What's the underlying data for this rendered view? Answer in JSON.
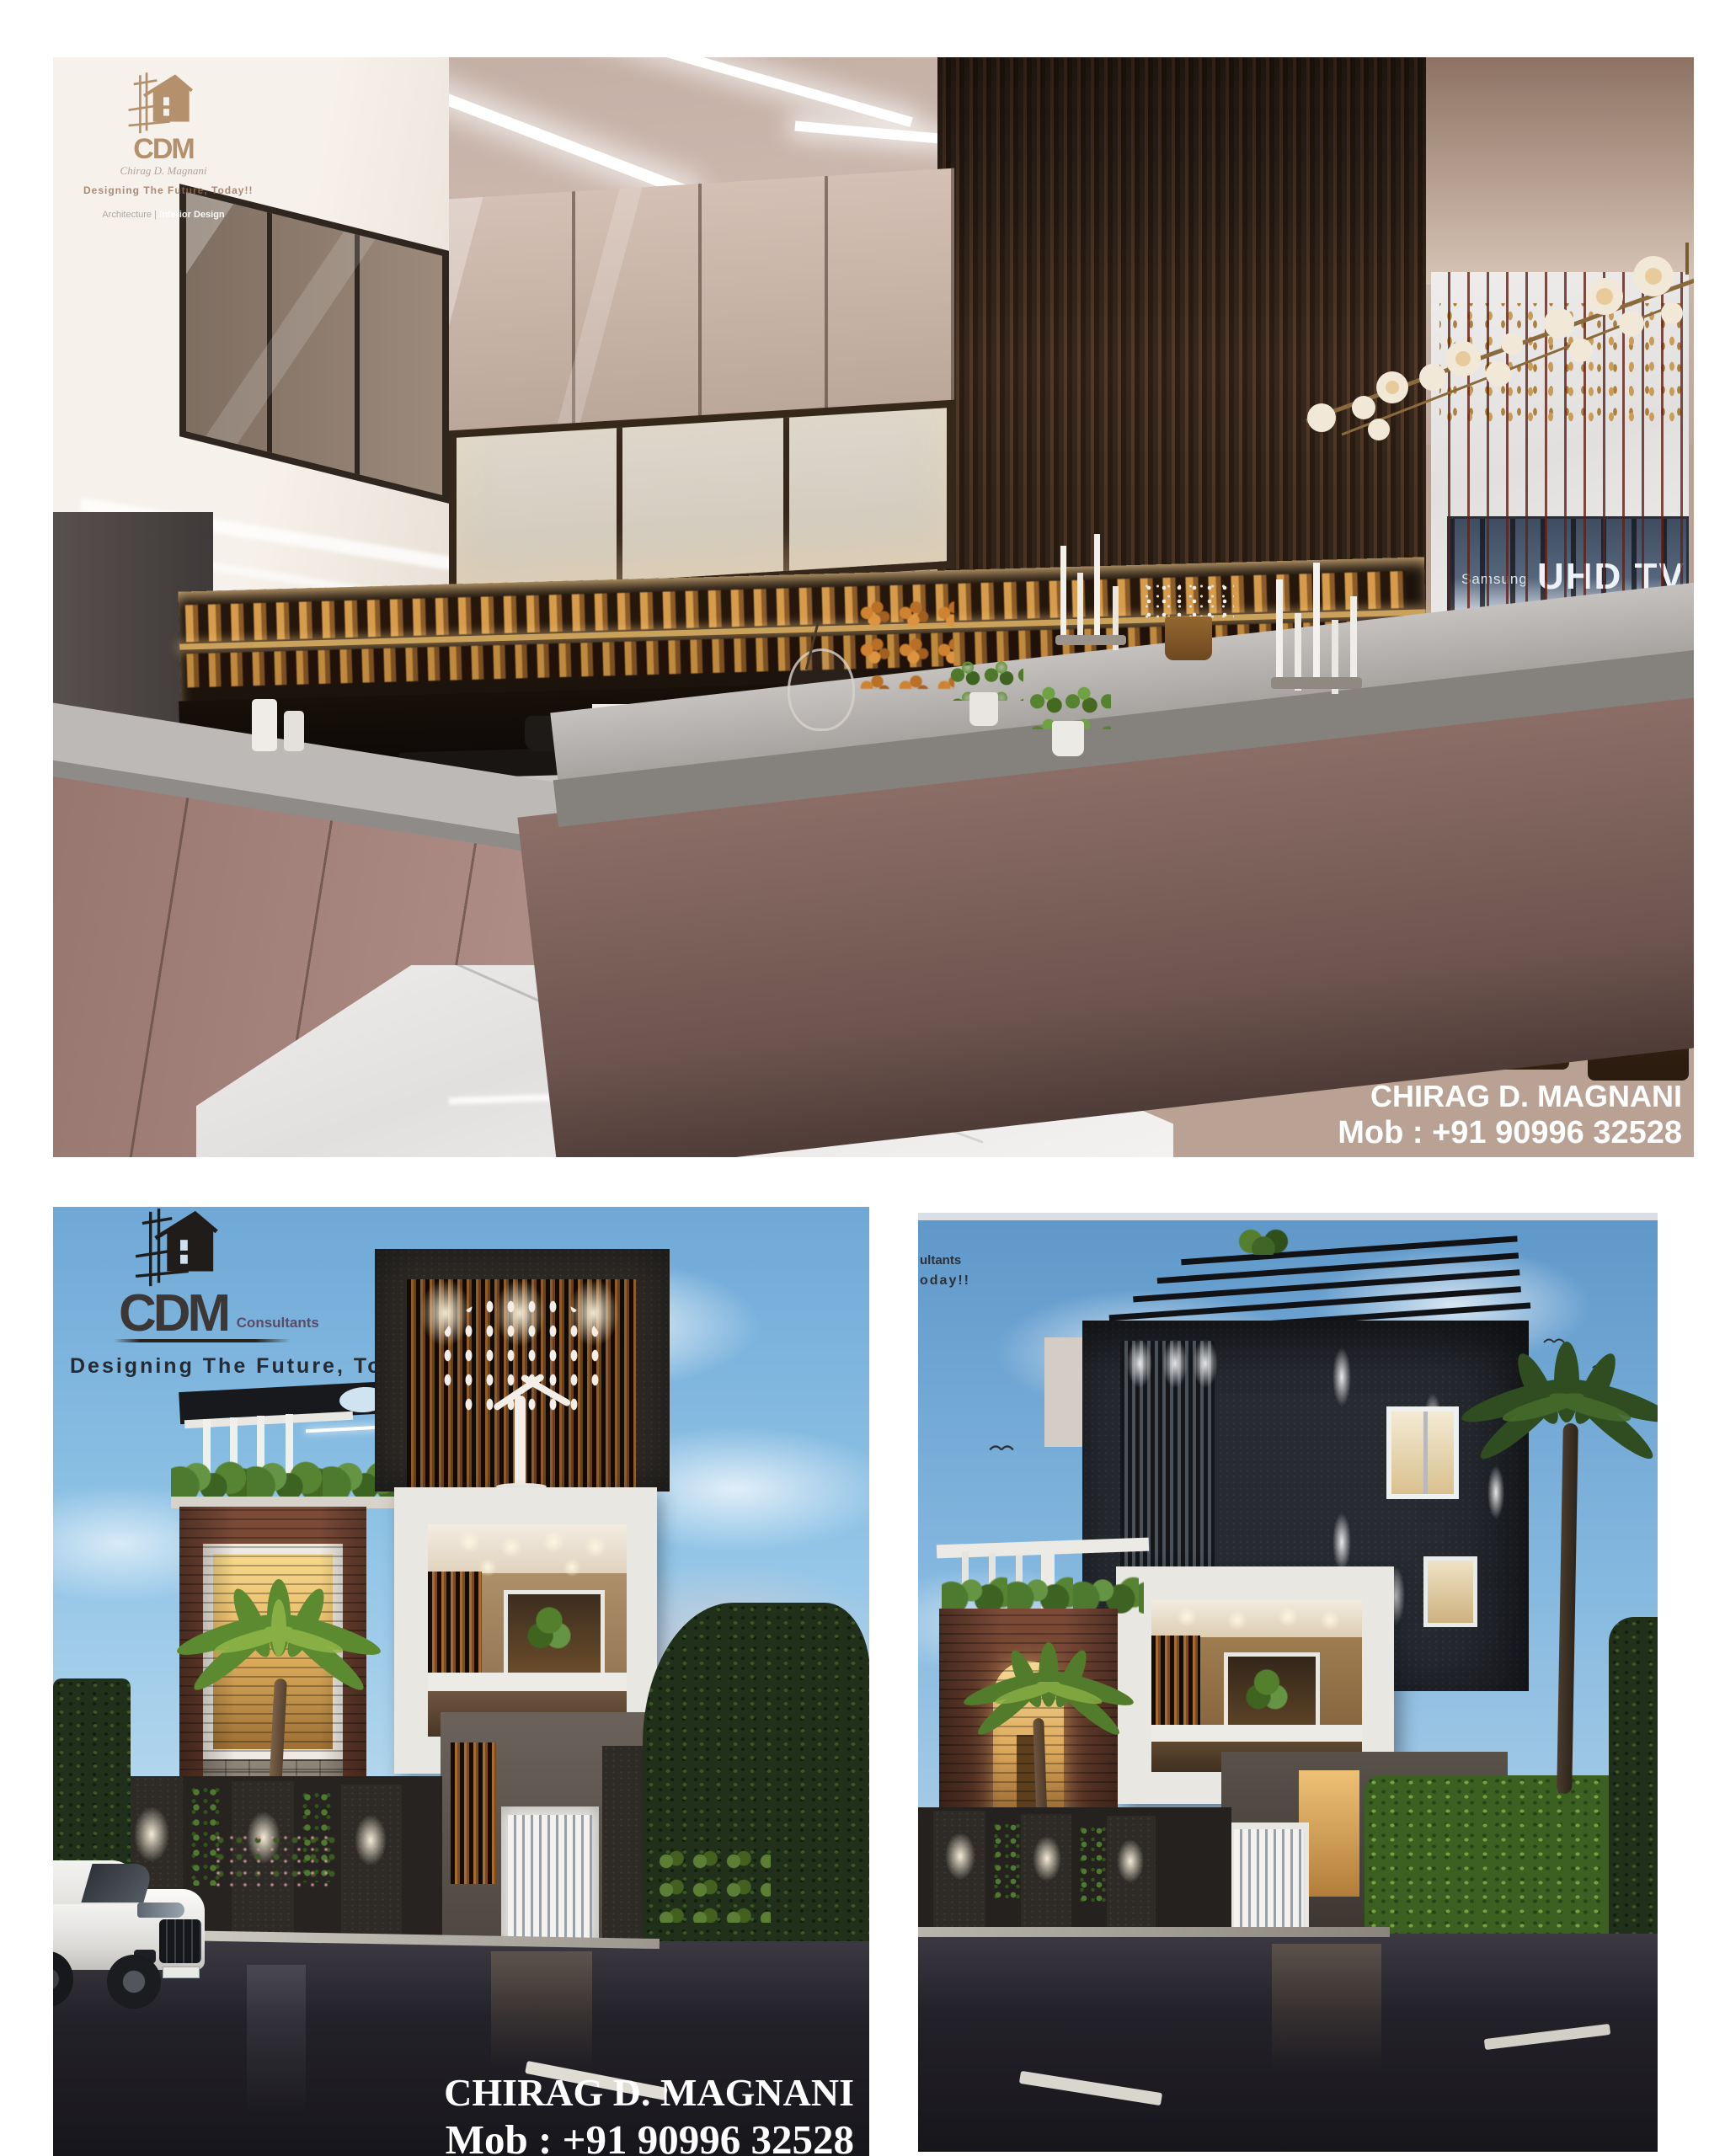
{
  "canvas": {
    "bg": "#ffffff"
  },
  "kitchen": {
    "logo": {
      "brand": "CDM",
      "signature": "Chirag D. Magnani",
      "tagline": "Designing The Future, Today!!",
      "subline_left": "Architecture |",
      "subline_right": "Interior Design"
    },
    "tv": {
      "brand": "Samsung",
      "model": "UHD TV",
      "subtitle": "Ultra High Definition 4K"
    },
    "caption": {
      "name": "CHIRAG D.  MAGNANI",
      "phone": "Mob : +91 90996 32528"
    }
  },
  "exterior_left": {
    "logo": {
      "brand": "CDM",
      "suffix": "Consultants",
      "tagline": "Designing The Future, Today!!"
    },
    "caption": {
      "name": "CHIRAG D. MAGNANI",
      "phone": "Mob : +91 90996 32528"
    }
  },
  "exterior_right": {
    "logo_fragment": {
      "line1": "ultants",
      "line2": "oday!!"
    }
  },
  "colors": {
    "accent_tan": "#b5906d",
    "sky": "#8fc3e6",
    "brick": "#74452f",
    "charcoal": "#2b2e35",
    "mauve": "#a8867d",
    "counter_grey": "#a19d9a"
  }
}
